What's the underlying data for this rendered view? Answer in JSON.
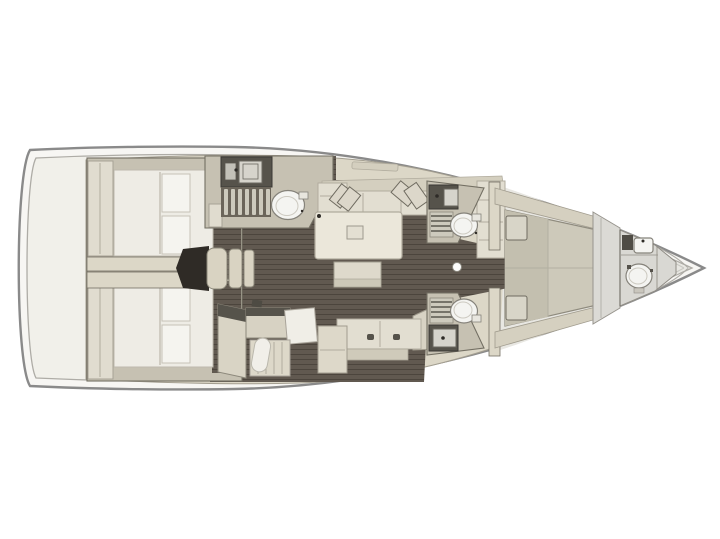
{
  "image": {
    "type": "sailing-yacht-interior-floor-plan",
    "view": "top-down",
    "orientation": "bow-right",
    "visible_text": ""
  },
  "regions": [
    "hull",
    "stern-deck",
    "aft-cabin-port",
    "aft-cabin-starboard",
    "companionway-stairs",
    "salon",
    "salon-sofa",
    "salon-table",
    "ottoman",
    "starboard-settee",
    "galley",
    "aft-head-port",
    "fwd-head-port",
    "fwd-head-starboard",
    "corridor",
    "mast-post",
    "owner-cabin",
    "bow-head",
    "foredeck"
  ],
  "colors": {
    "background": "#ffffff",
    "hull_line": "#8a8a8a",
    "hull_rim": "#f7f6f3",
    "deck_inner_line": "#aeaca6",
    "interior_base": "#f1f0ea",
    "deck_band": "#dcd7c7",
    "deck_band_line": "#a39e90",
    "foredeck": "#e8e7e2",
    "foredeck_line": "#c9c8c2",
    "floor": "#615950",
    "floor_line": "#4c453d",
    "floor_dark": "#37332d",
    "wall": "#c6c1b2",
    "wall_line": "#736f63",
    "furniture": "#e0dccf",
    "furniture_line": "#a7a295",
    "mattress": "#eeece5",
    "mattress_line": "#bdb9ad",
    "pillow": "#f5f4ef",
    "pillow_line": "#c6c2b7",
    "cushion": "#e2ded1",
    "cushion_line": "#b1ac9e",
    "counter_dark": "#56534b",
    "fixture_white": "#f4f4f1",
    "fixture_line": "#85827a",
    "grate": "#cdcabd",
    "grate_line": "#5a574e",
    "bed_khaki": "#cdc9ba",
    "bed_khaki_dark": "#c3bfaf",
    "bed_seam": "#b2afa1",
    "bulkhead_gray": "#dbdad5",
    "bulkhead_line": "#97948d",
    "stairs": "#d9d3c2",
    "stairs_bg": "#2f2b26",
    "mast_dot": "#fcfcfb"
  }
}
